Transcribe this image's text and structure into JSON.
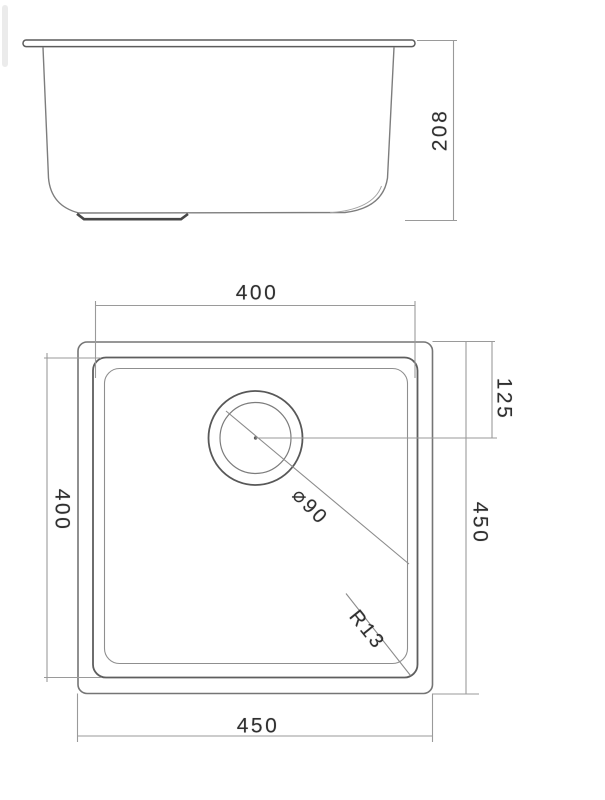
{
  "drawing": {
    "title": "undermount-sink-technical-drawing",
    "line_color_object": "#6a6a6a",
    "line_color_dimension": "#9a9a9a",
    "text_color": "#2f2f2f",
    "side_view": {
      "height_label": "208"
    },
    "plan_view": {
      "top_width_label": "400",
      "left_height_label": "400",
      "drain_offset_label": "125",
      "right_height_label": "450",
      "bottom_width_label": "450",
      "drain_diameter_label": "⌀90",
      "corner_radius_label": "R13"
    }
  }
}
